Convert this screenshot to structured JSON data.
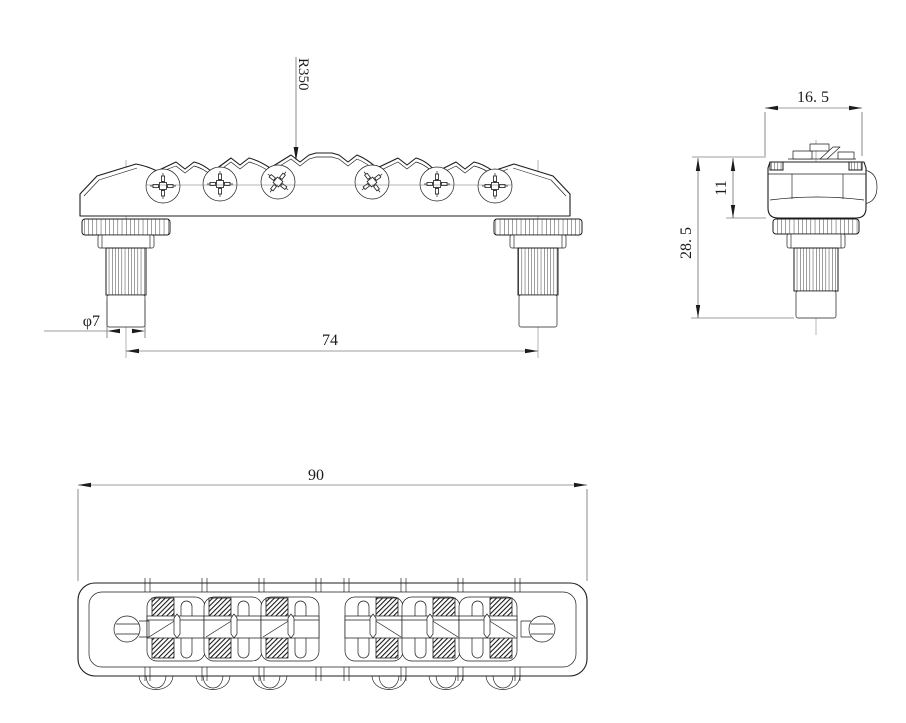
{
  "drawing": {
    "type": "technical-drawing",
    "background": "#ffffff",
    "line_color": "#1c1c1c",
    "front_view": {
      "dim_saddle_radius": "R350",
      "dim_post_spacing": "74",
      "dim_post_diameter": "φ7"
    },
    "side_view": {
      "dim_width": "16. 5",
      "dim_body_height": "11",
      "dim_total_height": "28. 5"
    },
    "plan_view": {
      "dim_overall_length": "90"
    }
  }
}
